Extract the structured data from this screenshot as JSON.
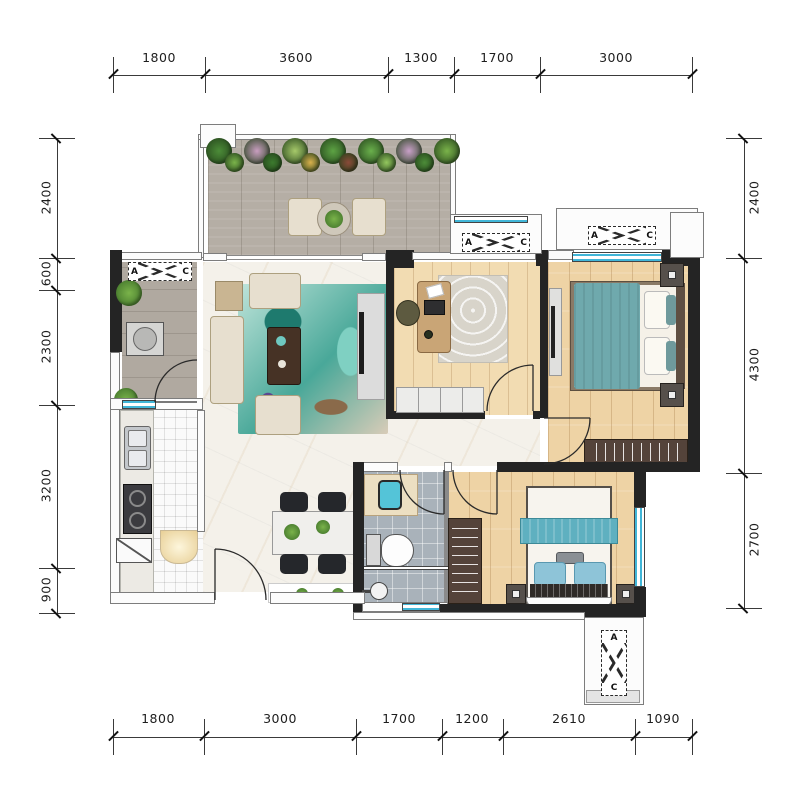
{
  "dimensions": {
    "top": [
      "1800",
      "3600",
      "1300",
      "1700",
      "3000"
    ],
    "bottom": [
      "1800",
      "3000",
      "1700",
      "1200",
      "2610",
      "1090"
    ],
    "left": [
      "2400",
      "600",
      "2300",
      "3200",
      "900"
    ],
    "right": [
      "2400",
      "4300",
      "2700"
    ]
  },
  "ac_unit": {
    "letter_a": "A",
    "letter_c": "C"
  },
  "balcony_plants": {
    "colors": [
      "#4c8c38",
      "#7ab34a",
      "#c99ec0",
      "#3c7a2e",
      "#a6c96a",
      "#d9b04c",
      "#5da344",
      "#8a4a38",
      "#6ab04c",
      "#94c75e",
      "#c9a0c8",
      "#4c8c38",
      "#7ab34a"
    ]
  },
  "colors": {
    "window_glass": "#41b6d8",
    "wall_dark": "#242424",
    "wood_floor": "#eed3a5",
    "wood_floor_light": "#f2dcb2",
    "balcony_floor": "#b5aea5",
    "marble_floor": "#f4f1ea",
    "bath_tile": "#a9b2ba",
    "kitchen_tile": "#fafafa",
    "rug_teal": "#4fb3a6",
    "blanket_teal": "#6fa9ad",
    "pillow_blue": "#8ec4d8",
    "sofa_cream": "#e7dfcf",
    "wardrobe_brown": "#54433a",
    "dim_line": "#3a3a3a"
  }
}
